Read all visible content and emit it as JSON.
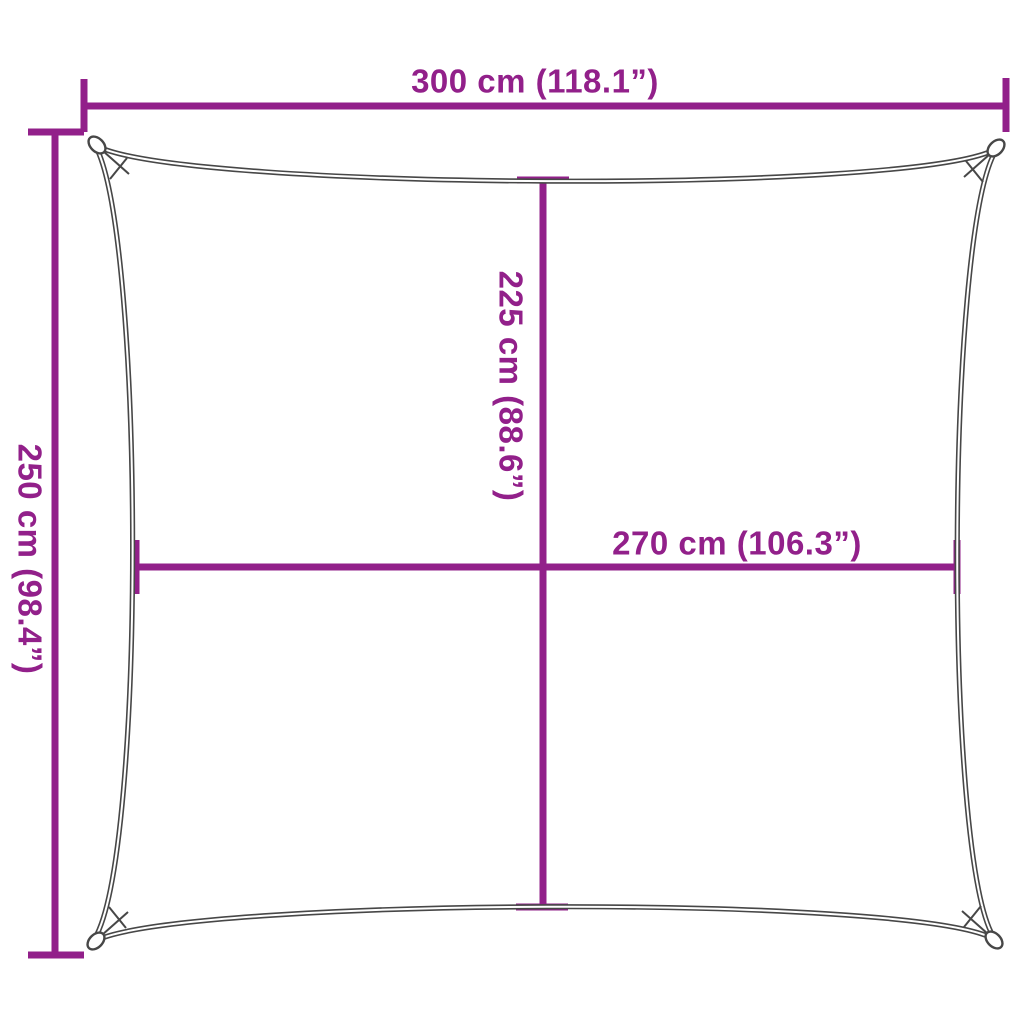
{
  "diagram": {
    "type": "product-dimension-diagram",
    "subject": "square shade sail with concave edges and corner grommets",
    "background_color": "#ffffff",
    "accent_color": "#92208a",
    "sail_line_color": "#474747",
    "dimensions": {
      "top_width": {
        "label": "300 cm (118.1”)",
        "cm": 300,
        "inches": 118.1
      },
      "left_height": {
        "label": "250 cm (98.4”)",
        "cm": 250,
        "inches": 98.4
      },
      "center_height": {
        "label": "225 cm (88.6”)",
        "cm": 225,
        "inches": 88.6
      },
      "center_width": {
        "label": "270 cm (106.3”)",
        "cm": 270,
        "inches": 106.3
      }
    }
  }
}
